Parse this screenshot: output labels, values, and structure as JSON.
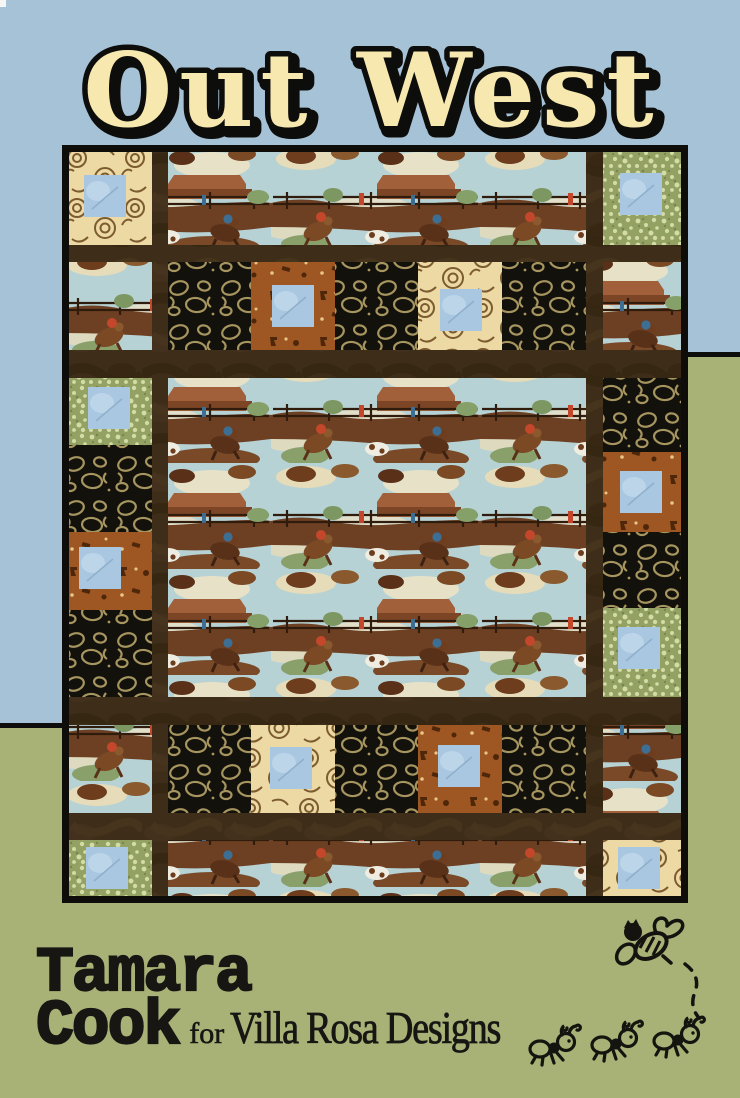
{
  "page": {
    "title": "Out West",
    "credits": {
      "author_first": "Tamara",
      "author_last": "Cook",
      "byline_connector": "for",
      "brand": "Villa Rosa Designs"
    },
    "icons": [
      "bee-icon",
      "flight-trail-dashed",
      "ant-icon",
      "ant-icon",
      "ant-icon"
    ],
    "colors": {
      "sky_blue_panel": "#a6c2d6",
      "sage_green_panel": "#a8b277",
      "title_cream": "#f6e8ae",
      "outline_black": "#0d0d0b",
      "quilt_sashing_brown": "#3e2d18",
      "accent_square_blue": "#a9c7e0"
    },
    "quilt": {
      "description": "Photograph of the Out West quilt",
      "fabrics": [
        "western cowboy scenic print",
        "black lasso rope print",
        "cream swirl print",
        "rust tack print",
        "green pebble print",
        "light blue center squares",
        "dark brown sashing",
        "black binding"
      ]
    }
  }
}
